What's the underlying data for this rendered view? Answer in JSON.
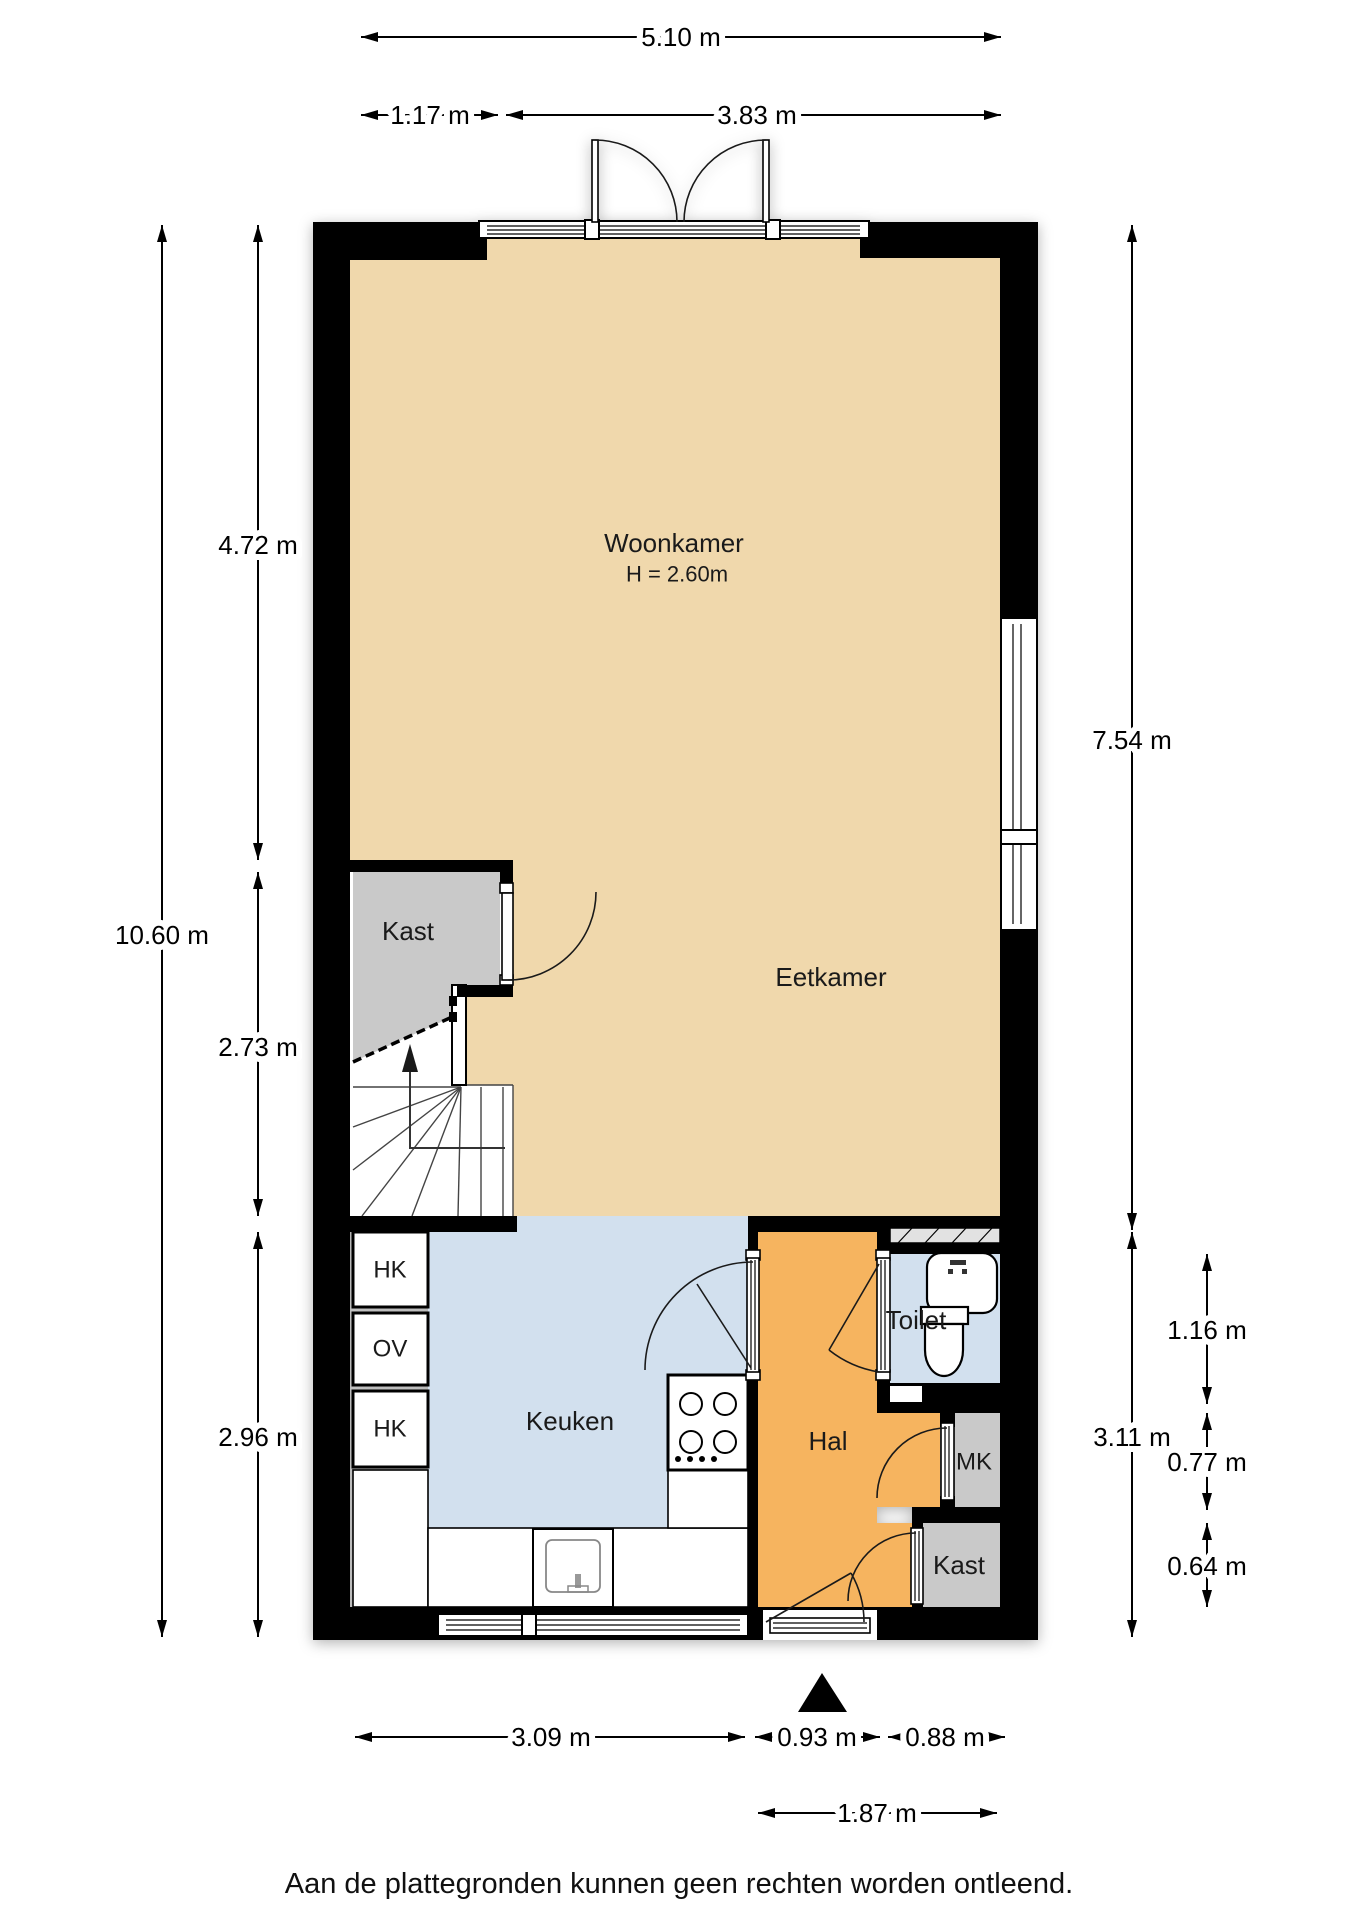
{
  "rooms": {
    "woonkamer": {
      "label": "Woonkamer",
      "height_note": "H = 2.60m"
    },
    "eetkamer": {
      "label": "Eetkamer"
    },
    "kast_upper": {
      "label": "Kast"
    },
    "keuken": {
      "label": "Keuken"
    },
    "hal": {
      "label": "Hal"
    },
    "toilet": {
      "label": "Toilet"
    },
    "mk": {
      "label": "MK"
    },
    "kast_lower": {
      "label": "Kast"
    },
    "hk_top": {
      "label": "HK"
    },
    "ov": {
      "label": "OV"
    },
    "hk_bottom": {
      "label": "HK"
    }
  },
  "dimensions": {
    "top_total": "5.10 m",
    "top_left": "1.17 m",
    "top_right": "3.83 m",
    "left_upper": "4.72 m",
    "left_total": "10.60 m",
    "left_middle": "2.73 m",
    "left_lower": "2.96 m",
    "right_upper": "7.54 m",
    "right_lower": "3.11 m",
    "right_toilet": "1.16 m",
    "right_mk": "0.77 m",
    "right_kast": "0.64 m",
    "bottom_keuken": "3.09 m",
    "bottom_hal": "0.93 m",
    "bottom_right": "0.88 m",
    "bottom_entry": "1.87 m"
  },
  "footer": {
    "disclaimer": "Aan de plattegronden kunnen geen rechten worden ontleend."
  },
  "colors": {
    "floor": "#f0d8ac",
    "hall": "#f6b45f",
    "wet": "#d2e0ee",
    "closet": "#c9c9c9",
    "shaft": "#e2e2e2",
    "wall": "#000000"
  }
}
